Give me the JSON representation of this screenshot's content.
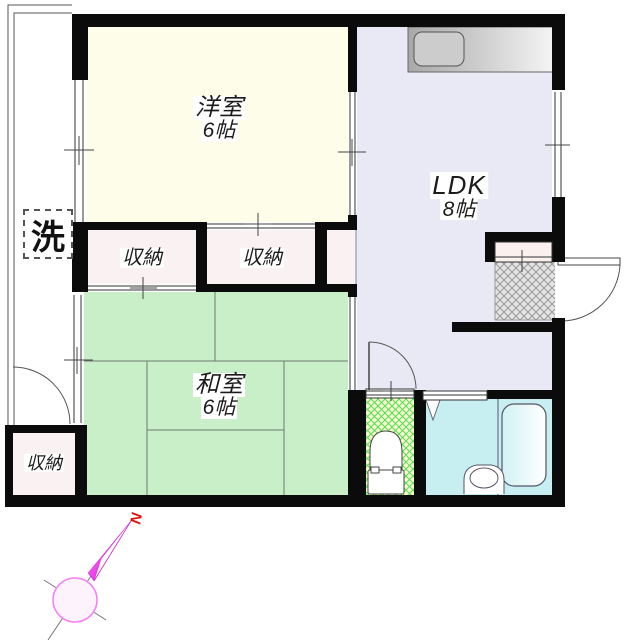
{
  "rooms": {
    "western_room": {
      "label": "洋室",
      "size": "6帖"
    },
    "ldk": {
      "label": "LDK",
      "size": "8帖"
    },
    "japanese_room": {
      "label": "和室",
      "size": "6帖"
    }
  },
  "closets": [
    {
      "label": "収納"
    },
    {
      "label": "収納"
    },
    {
      "label": "収納"
    }
  ],
  "laundry": {
    "label": "洗"
  },
  "compass": {
    "north_label": "N"
  },
  "colors": {
    "wall": "#0b0b0b",
    "western_room_fill": "#fdfde9",
    "ldk_fill": "#e9e9f6",
    "japanese_room_fill": "#c9efc8",
    "closet_fill": "#faf1f2",
    "toilet_fill": "#f8f8cf",
    "toilet_hatch": "#55dd55",
    "bathroom_fill": "#c7eff2",
    "genkan_floor": "#e4e4e4",
    "genkan_hatch": "#999999",
    "kitchen_counter": "#b0b0b0",
    "compass_needle": "#ee22ee",
    "compass_circle": "#f87df8",
    "north_mark_color": "#dd1111"
  }
}
